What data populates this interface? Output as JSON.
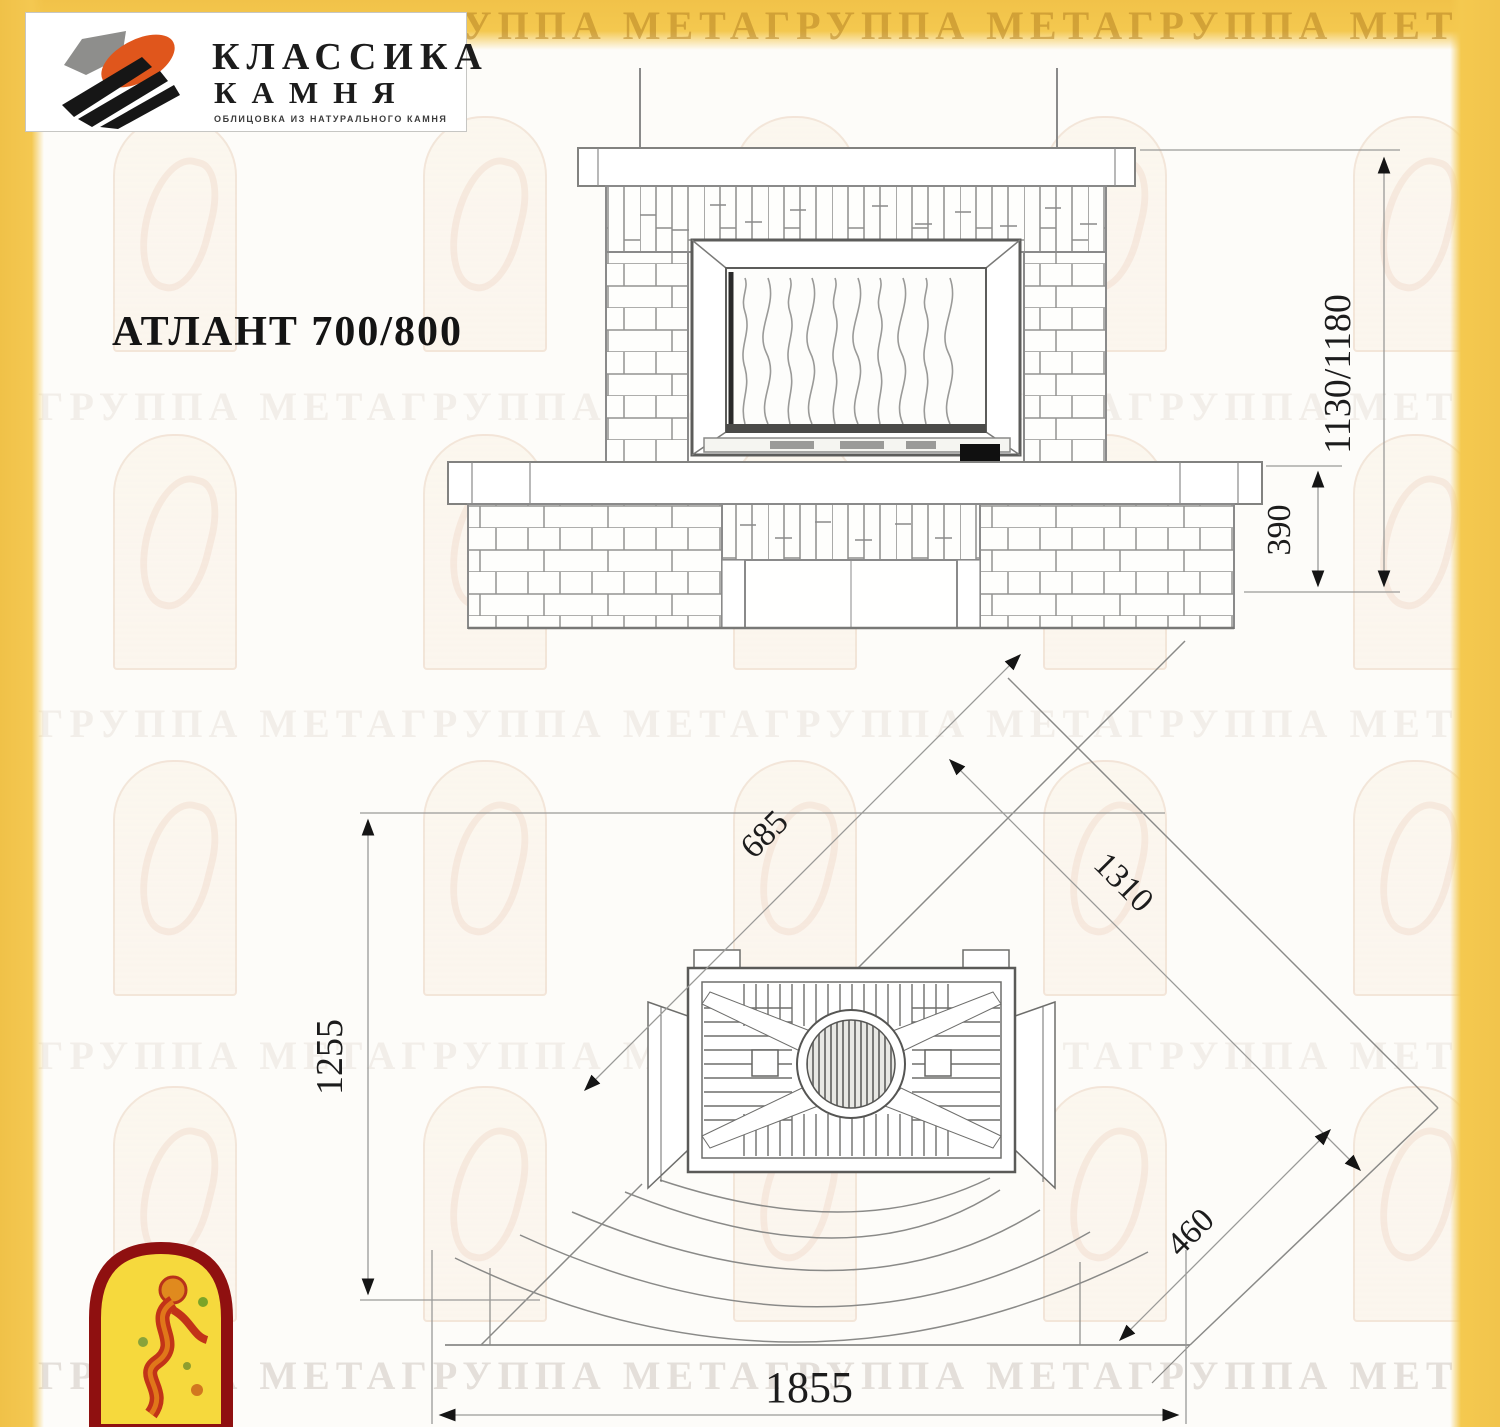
{
  "brand": {
    "name_line1": "КЛАССИКА",
    "name_line2": "КАМНЯ",
    "tagline": "ОБЛИЦОВКА ИЗ НАТУРАЛЬНОГО КАМНЯ"
  },
  "title": {
    "model": "АТЛАНТ 700/800"
  },
  "watermark": {
    "text_row": "ГРУППА МЕТАГРУППА МЕТАГРУППА МЕТАГРУППА МЕТАГРУППА МЕТА"
  },
  "front_view": {
    "label": "front-elevation",
    "dim_total_height": "1130/1180",
    "dim_base_height": "390"
  },
  "plan_view": {
    "label": "corner-plan",
    "dim_depth": "1255",
    "dim_left_side": "685",
    "dim_right_side": "1310",
    "dim_corner_cut": "460",
    "dim_front_width": "1855"
  },
  "colors": {
    "frame_yellow": "#F3C74F",
    "line_gray": "#8A8A8A",
    "dim_text": "#1C1C1C",
    "logo_orange": "#E0561C",
    "meta_logo_red": "#8F1010",
    "meta_logo_yellow": "#F6D93D"
  }
}
